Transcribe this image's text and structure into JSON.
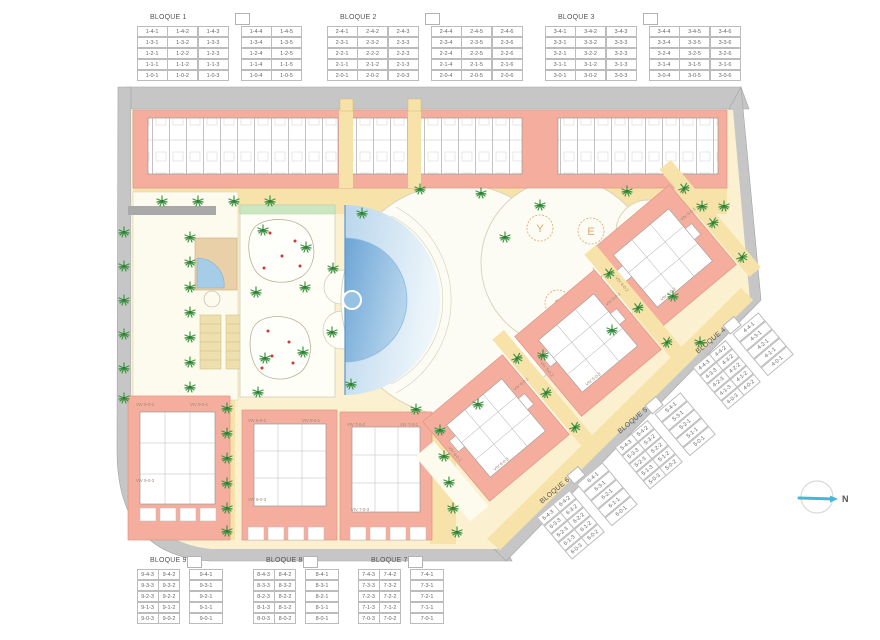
{
  "compass": {
    "label": "N"
  },
  "plan": {
    "play_glyphs": [
      "Y",
      "E",
      "A",
      "S"
    ],
    "viv_labels": [
      "VIV 4-0-1",
      "VIV 4-0-2",
      "VIV 4-0-3",
      "VIV 5-0-1",
      "VIV 5-0-2",
      "VIV 5-0-3",
      "VIV 6-0-1",
      "VIV 6-0-2",
      "VIV 6-0-3",
      "VIV 9-0-2",
      "VIV 9-0-1",
      "VIV 9-0-3",
      "VIV 8-0-2",
      "VIV 8-0-1",
      "VIV 8-0-3",
      "VIV 7-0-2",
      "VIV 7-0-1",
      "VIV 7-0-3"
    ]
  },
  "bloques": [
    {
      "name": "BLOQUE 1",
      "gap_after": 3,
      "rows": [
        [
          "1-4-1",
          "1-4-2",
          "1-4-3",
          "1-4-4",
          "1-4-5"
        ],
        [
          "1-3-1",
          "1-3-2",
          "1-3-3",
          "1-3-4",
          "1-3-5"
        ],
        [
          "1-2-1",
          "1-2-2",
          "1-2-3",
          "1-2-4",
          "1-2-5"
        ],
        [
          "1-1-1",
          "1-1-2",
          "1-1-3",
          "1-1-4",
          "1-1-5"
        ],
        [
          "1-0-1",
          "1-0-2",
          "1-0-3",
          "1-0-4",
          "1-0-5"
        ]
      ]
    },
    {
      "name": "BLOQUE 2",
      "gap_after": 3,
      "rows": [
        [
          "2-4-1",
          "2-4-2",
          "2-4-3",
          "2-4-4",
          "2-4-5",
          "2-4-6"
        ],
        [
          "2-3-1",
          "2-3-2",
          "2-3-3",
          "2-3-4",
          "2-3-5",
          "2-3-6"
        ],
        [
          "2-2-1",
          "2-2-2",
          "2-2-3",
          "2-2-4",
          "2-2-5",
          "2-2-6"
        ],
        [
          "2-1-1",
          "2-1-2",
          "2-1-3",
          "2-1-4",
          "2-1-5",
          "2-1-6"
        ],
        [
          "2-0-1",
          "2-0-2",
          "2-0-3",
          "2-0-4",
          "2-0-5",
          "2-0-6"
        ]
      ]
    },
    {
      "name": "BLOQUE 3",
      "gap_after": 3,
      "rows": [
        [
          "3-4-1",
          "3-4-2",
          "3-4-3",
          "3-4-4",
          "3-4-5",
          "3-4-6"
        ],
        [
          "3-3-1",
          "3-3-2",
          "3-3-3",
          "3-3-4",
          "3-3-5",
          "3-3-6"
        ],
        [
          "3-2-1",
          "3-2-2",
          "3-2-3",
          "3-2-4",
          "3-2-5",
          "3-2-6"
        ],
        [
          "3-1-1",
          "3-1-2",
          "3-1-3",
          "3-1-4",
          "3-1-5",
          "3-1-6"
        ],
        [
          "3-0-1",
          "3-0-2",
          "3-0-3",
          "3-0-4",
          "3-0-5",
          "3-0-6"
        ]
      ]
    },
    {
      "name": "BLOQUE 4",
      "gap_after": 2,
      "rows": [
        [
          "4-4-3",
          "4-4-2",
          "4-4-1"
        ],
        [
          "4-3-3",
          "4-3-2",
          "4-3-1"
        ],
        [
          "4-2-3",
          "4-2-2",
          "4-2-1"
        ],
        [
          "4-1-3",
          "4-1-2",
          "4-1-1"
        ],
        [
          "4-0-3",
          "4-0-2",
          "4-0-1"
        ]
      ]
    },
    {
      "name": "BLOQUE 5",
      "gap_after": 2,
      "rows": [
        [
          "5-4-3",
          "5-4-2",
          "5-4-1"
        ],
        [
          "5-3-3",
          "5-3-2",
          "5-3-1"
        ],
        [
          "5-2-3",
          "5-2-2",
          "5-2-1"
        ],
        [
          "5-1-3",
          "5-1-2",
          "5-1-1"
        ],
        [
          "5-0-3",
          "5-0-2",
          "5-0-1"
        ]
      ]
    },
    {
      "name": "BLOQUE 6",
      "gap_after": 2,
      "rows": [
        [
          "6-4-3",
          "6-4-2",
          "6-4-1"
        ],
        [
          "6-3-3",
          "6-3-2",
          "6-3-1"
        ],
        [
          "6-2-3",
          "6-2-2",
          "6-2-1"
        ],
        [
          "6-1-3",
          "6-1-2",
          "6-1-1"
        ],
        [
          "6-0-3",
          "6-0-2",
          "6-0-1"
        ]
      ]
    },
    {
      "name": "BLOQUE 7",
      "gap_after": 2,
      "rows": [
        [
          "7-4-3",
          "7-4-2",
          "7-4-1"
        ],
        [
          "7-3-3",
          "7-3-2",
          "7-3-1"
        ],
        [
          "7-2-3",
          "7-2-2",
          "7-2-1"
        ],
        [
          "7-1-3",
          "7-1-2",
          "7-1-1"
        ],
        [
          "7-0-3",
          "7-0-2",
          "7-0-1"
        ]
      ]
    },
    {
      "name": "BLOQUE 8",
      "gap_after": 2,
      "rows": [
        [
          "8-4-3",
          "8-4-2",
          "8-4-1"
        ],
        [
          "8-3-3",
          "8-3-2",
          "8-3-1"
        ],
        [
          "8-2-3",
          "8-2-2",
          "8-2-1"
        ],
        [
          "8-1-3",
          "8-1-2",
          "8-1-1"
        ],
        [
          "8-0-3",
          "8-0-2",
          "8-0-1"
        ]
      ]
    },
    {
      "name": "BLOQUE 9",
      "gap_after": 2,
      "rows": [
        [
          "9-4-3",
          "9-4-2",
          "9-4-1"
        ],
        [
          "9-3-3",
          "9-3-2",
          "9-3-1"
        ],
        [
          "9-2-3",
          "9-2-2",
          "9-2-1"
        ],
        [
          "9-1-3",
          "9-1-2",
          "9-1-1"
        ],
        [
          "9-0-3",
          "9-0-2",
          "9-0-1"
        ]
      ]
    }
  ]
}
